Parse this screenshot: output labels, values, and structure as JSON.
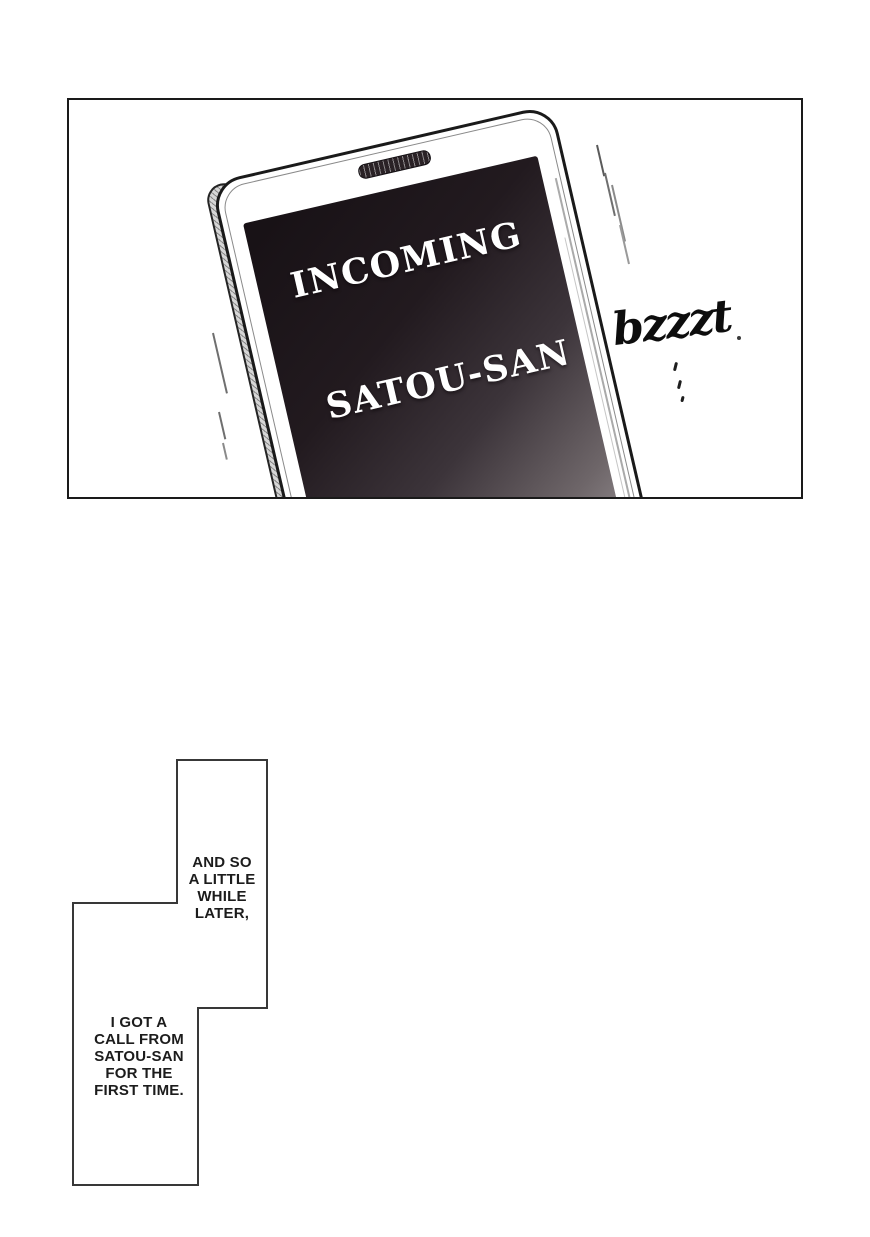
{
  "panel": {
    "phone": {
      "line1": "INCOMING",
      "line2": "SATOU-SAN"
    },
    "sfx": "bzzzt"
  },
  "captions": {
    "first": "AND SO\nA LITTLE\nWHILE\nLATER,",
    "second": "I GOT A\nCALL FROM\nSATOU-SAN\nFOR THE\nFIRST TIME."
  },
  "colors": {
    "panel_border": "#1a1a1a",
    "caption_border": "#383838",
    "screen_dark": "#171115",
    "screen_light": "#dcd8da",
    "ink": "#0d0d0d"
  }
}
